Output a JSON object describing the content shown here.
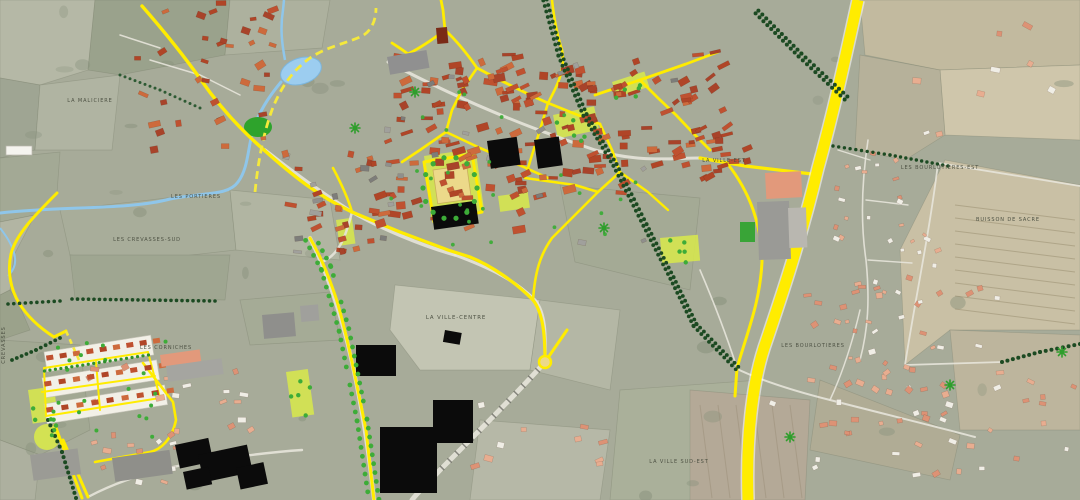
{
  "map": {
    "type": "urban-planning-aerial-map",
    "labels": [
      {
        "id": "la-maliciere",
        "text": "LA MALICIERE",
        "x": 90,
        "y": 102,
        "rot": 0,
        "size": 5
      },
      {
        "id": "les-portieres",
        "text": "LES PORTIERES",
        "x": 196,
        "y": 198,
        "rot": 0,
        "size": 5
      },
      {
        "id": "les-crevasses-sud",
        "text": "LES CREVASSES-SUD",
        "x": 147,
        "y": 241,
        "rot": 0,
        "size": 5
      },
      {
        "id": "les-corniches",
        "text": "LES CORNICHES",
        "x": 166,
        "y": 349,
        "rot": 0,
        "size": 5
      },
      {
        "id": "la-ville-centre",
        "text": "LA VILLE-CENTRE",
        "x": 456,
        "y": 319,
        "rot": 0,
        "size": 5.4
      },
      {
        "id": "la-ville-est",
        "text": "LA VILLE-EST",
        "x": 724,
        "y": 162,
        "rot": 0,
        "size": 5
      },
      {
        "id": "les-bourlotieres-est",
        "text": "LES BOURLOTIERES-EST",
        "x": 940,
        "y": 169,
        "rot": 0,
        "size": 5
      },
      {
        "id": "buisson-de-sacre",
        "text": "BUISSON DE SACRE",
        "x": 1008,
        "y": 221,
        "rot": 0,
        "size": 5
      },
      {
        "id": "les-bourlotieres",
        "text": "LES BOURLOTIERES",
        "x": 813,
        "y": 347,
        "rot": 0,
        "size": 5
      },
      {
        "id": "la-ville-sud-est",
        "text": "LA VILLE SUD-EST",
        "x": 679,
        "y": 463,
        "rot": 0,
        "size": 5
      },
      {
        "id": "crevasses-edge",
        "text": "CREVASSES",
        "x": 5,
        "y": 345,
        "rot": -90,
        "size": 5
      }
    ],
    "palette": {
      "background": "#a7ab99",
      "road_yellow": "#ffec00",
      "road_white": "#e7e4da",
      "greenway_dash": "#f5e93c",
      "water": "#8fc6ea",
      "pond": "#9ccdf0",
      "building_orange": "#bf5130",
      "building_salmon": "#e2997b",
      "building_black": "#0b0b0b",
      "building_gray": "#8f8f8c",
      "tree_green": "#3dac38",
      "hedge_green": "#1c4a22",
      "zone_chartreuse": "#d6e54f",
      "square_tan": "#ecd98a",
      "label_color": "#4d5143"
    }
  }
}
